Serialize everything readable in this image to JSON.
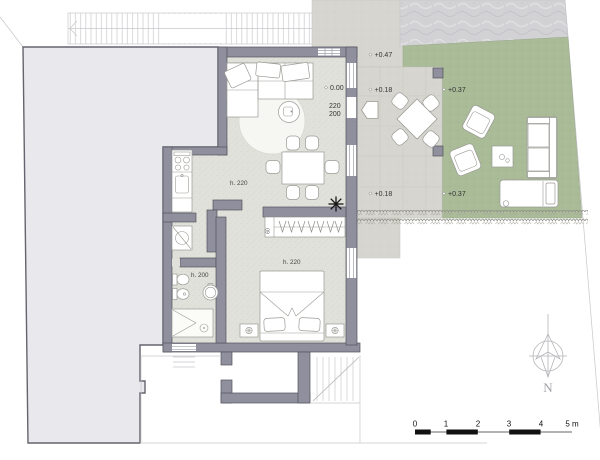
{
  "drawing": {
    "type": "architectural-floor-plan",
    "elevations": {
      "path_north": "+0.47",
      "interior_floor": "0.00",
      "patio_a": "+0.18",
      "garden_a": "+0.37",
      "patio_b": "+0.18",
      "garden_b": "+0.37"
    },
    "opening_dims": {
      "width": "220",
      "height": "200"
    },
    "room_heights": {
      "living_kitchen": "h. 220",
      "bathroom": "h. 200",
      "bedroom": "h. 220"
    },
    "wardrobe_depth": "60",
    "compass_north": "N",
    "scale_bar": {
      "ticks": [
        "0",
        "1",
        "2",
        "3",
        "4"
      ],
      "unit_label": "5 m"
    },
    "colors": {
      "wall": "#8f8f9d",
      "neighbor_fill": "#e9e9ed",
      "floor": "#e1e1db",
      "patio": "#d6d5cf",
      "gravel": "#d2d2d5",
      "lawn": "#aabb98"
    }
  }
}
